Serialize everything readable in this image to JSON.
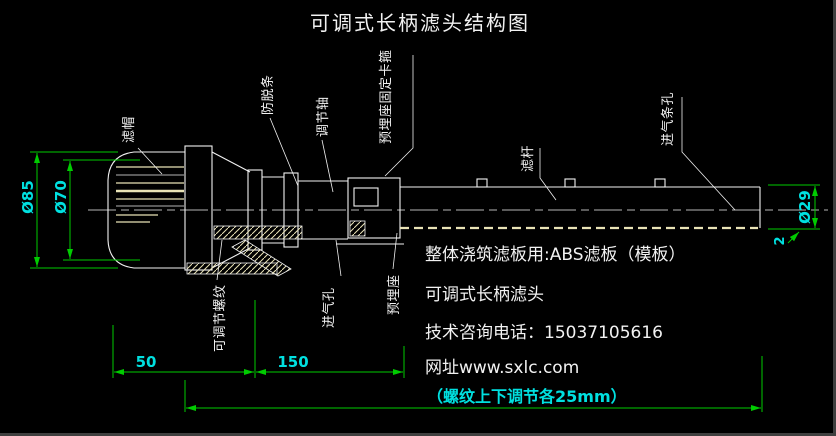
{
  "window": {
    "title": "可调式长柄滤头结构图"
  },
  "colors": {
    "background": "#000000",
    "line": "#f2f2f2",
    "cream": "#e9e3b6",
    "dimension": "#00cc00",
    "dim_text": "#00e0e0"
  },
  "part_labels": {
    "cap": "滤帽",
    "anti_slip_strip": "防脱条",
    "adjust_shaft": "调节轴",
    "embedded_clamp": "预埋座固定卡箍",
    "filter_rod": "滤杆",
    "air_slot_holes": "进气条孔",
    "adjustable_thread": "可调节螺纹",
    "air_hole": "进气孔",
    "embedded_seat": "预埋座"
  },
  "dimensions": {
    "cap_outer_dia": "Ø85",
    "cap_slot_dia": "Ø70",
    "rod_dia": "Ø29",
    "wall_thickness": "2",
    "cap_length": "50",
    "thread_length": "150"
  },
  "notes": {
    "board_note": "整体浇筑滤板用:ABS滤板（模板）",
    "product_name": "可调式长柄滤头",
    "phone": "技术咨询电话：15037105616",
    "website": "网址www.sxlc.com",
    "thread_adjust_note": "（螺纹上下调节各25mm）"
  }
}
